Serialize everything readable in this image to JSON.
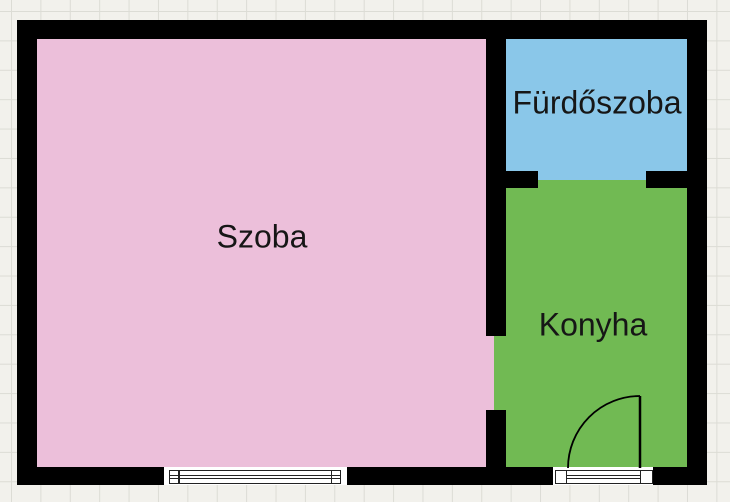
{
  "diagram": {
    "type": "floor-plan",
    "palette": {
      "paper_background": "#f2f1ec",
      "grid_line": "#dcdcd5",
      "wall": "#000000",
      "opening_fill": "#ffffff",
      "label_text": "#161616"
    },
    "rooms": [
      {
        "label": "Szoba",
        "fill": "#ecbfda"
      },
      {
        "label": "Fürdőszoba",
        "fill": "#8ac7e9"
      },
      {
        "label": "Konyha",
        "fill": "#71ba53"
      }
    ],
    "symbols": {
      "window": "double-pane-window-symbol",
      "door": "quarter-arc-swing-door-symbol",
      "door_sill": "lined-threshold-symbol",
      "interior_openings": [
        "doorway-between-szoba-and-konyha",
        "doorway-between-furdoszoba-and-konyha"
      ]
    }
  }
}
